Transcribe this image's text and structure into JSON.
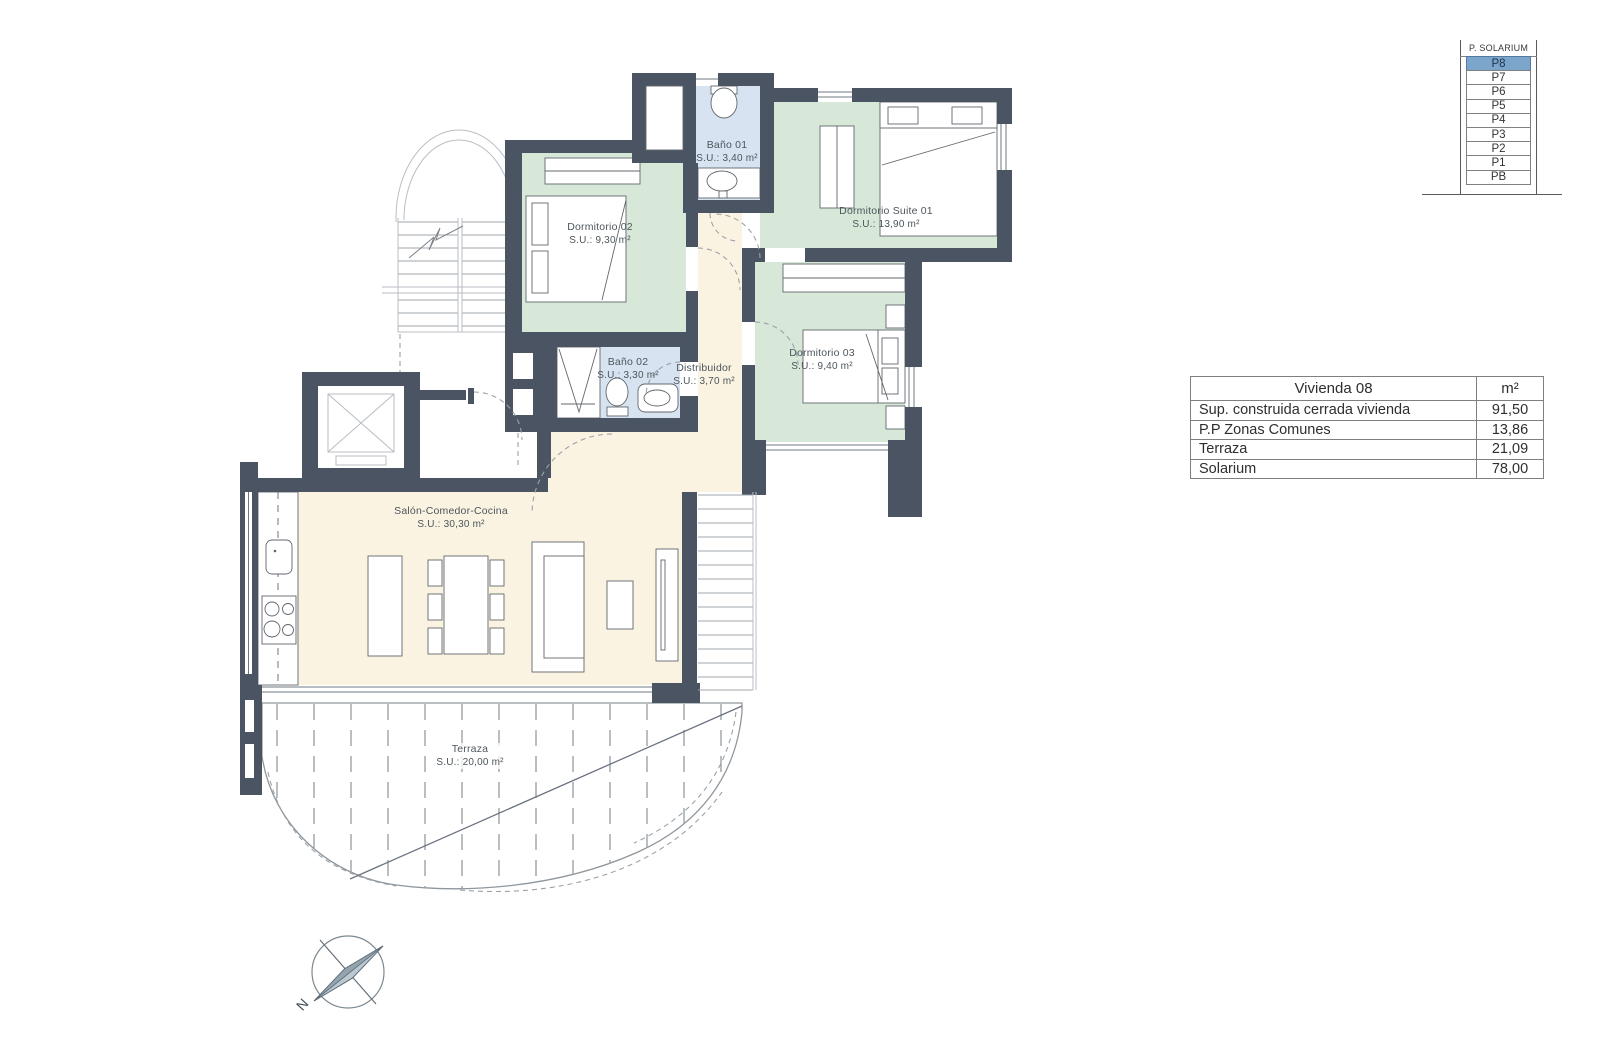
{
  "plan": {
    "rooms": [
      {
        "name": "Baño 01",
        "area": "S.U.: 3,40 m²"
      },
      {
        "name": "Dormitorio 02",
        "area": "S.U.: 9,30 m²"
      },
      {
        "name": "Dormitorio Suite 01",
        "area": "S.U.: 13,90 m²"
      },
      {
        "name": "Dormitorio 03",
        "area": "S.U.: 9,40 m²"
      },
      {
        "name": "Baño 02",
        "area": "S.U.: 3,30 m²"
      },
      {
        "name": "Distribuidor",
        "area": "S.U.: 3,70 m²"
      },
      {
        "name": "Salón-Comedor-Cocina",
        "area": "S.U.: 30,30 m²"
      },
      {
        "name": "Terraza",
        "area": "S.U.: 20,00 m²"
      }
    ],
    "compass_label": "N"
  },
  "floor_selector": {
    "header": "P. SOLARIUM",
    "selected": "P8",
    "floors": [
      "P8",
      "P7",
      "P6",
      "P5",
      "P4",
      "P3",
      "P2",
      "P1",
      "PB"
    ]
  },
  "area_table": {
    "title": "Vivienda 08",
    "unit_header": "m²",
    "rows": [
      {
        "label": "Sup. construida cerrada vivienda",
        "value": "91,50"
      },
      {
        "label": "P.P Zonas Comunes",
        "value": "13,86"
      },
      {
        "label": "Terraza",
        "value": "21,09"
      },
      {
        "label": "Solarium",
        "value": "78,00"
      }
    ]
  },
  "colors": {
    "wall": "#4a5462",
    "room-green": "#d8e8d8",
    "room-blue": "#d7e3f0",
    "room-cream": "#faf3e2",
    "selected-floor": "#7ba5ca"
  }
}
